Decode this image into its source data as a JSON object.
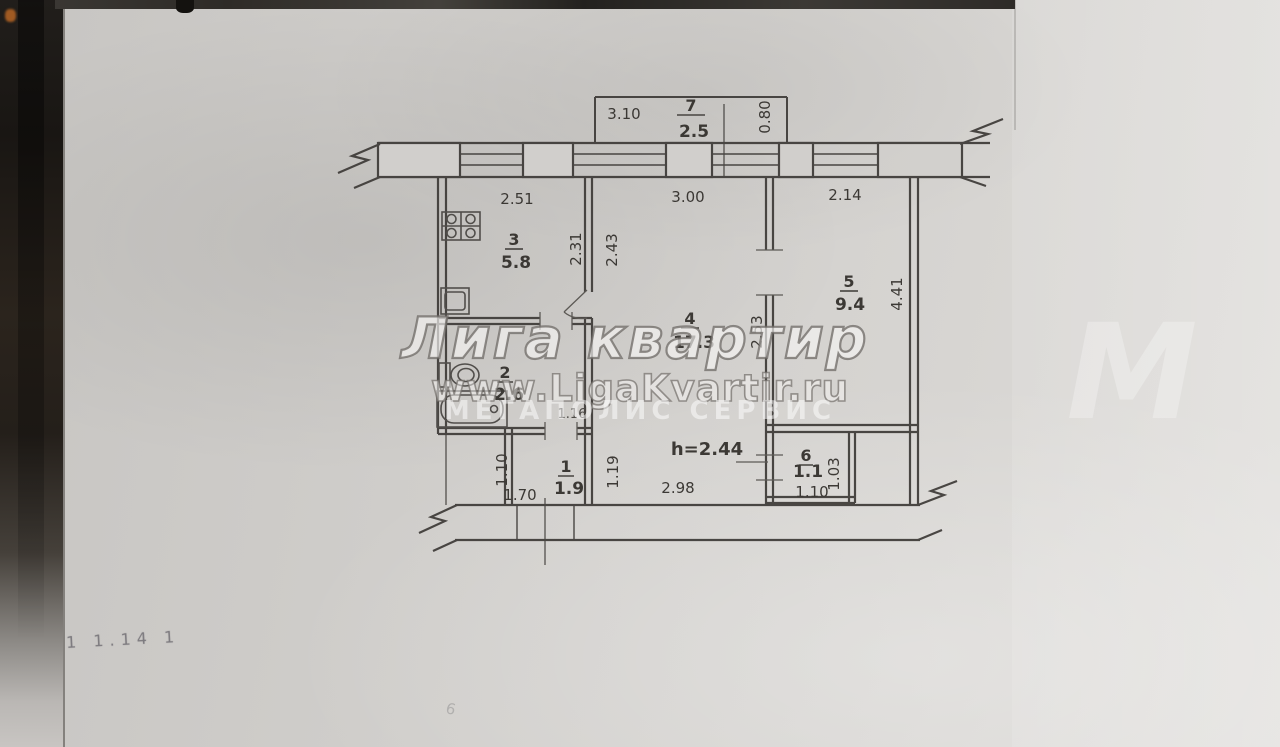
{
  "watermark": {
    "title": "Лига квартир",
    "url": "www.LigaKvartir.ru",
    "subtitle": "МЕГАПОЛИС СЕРВИС",
    "logo_letter": "М"
  },
  "plan": {
    "ceiling_height": "h=2.44",
    "rooms": {
      "balcony_top": {
        "number": "7",
        "area": "2.5"
      },
      "kitchen": {
        "number": "3",
        "area": "5.8"
      },
      "living_room": {
        "number": "4",
        "area": "17.3"
      },
      "bedroom": {
        "number": "5",
        "area": "9.4"
      },
      "hallway": {
        "number": "1",
        "area": "1.9"
      },
      "bathroom": {
        "number": "2",
        "area": "2.6"
      },
      "balcony_bottom": {
        "number": "6",
        "area": "1.1"
      }
    },
    "dimensions": {
      "balcony_top_width": "3.10",
      "balcony_top_depth": "0.80",
      "kitchen_width": "2.51",
      "living_width": "3.00",
      "bedroom_width": "2.14",
      "kitchen_depth": "2.31",
      "living_depth_left": "2.43",
      "living_depth_right": "2.53",
      "bedroom_depth": "4.41",
      "hall_depth_left": "1.10",
      "hall_depth_right": "1.19",
      "hall_door_width": "1.16",
      "bath_width": "1.70",
      "living_bottom_width": "2.98",
      "balcony_bottom_width": "1.10",
      "balcony_bottom_depth": "1.03"
    },
    "handwritten_note": "1 1.14 1",
    "handwritten_mark": "6"
  }
}
